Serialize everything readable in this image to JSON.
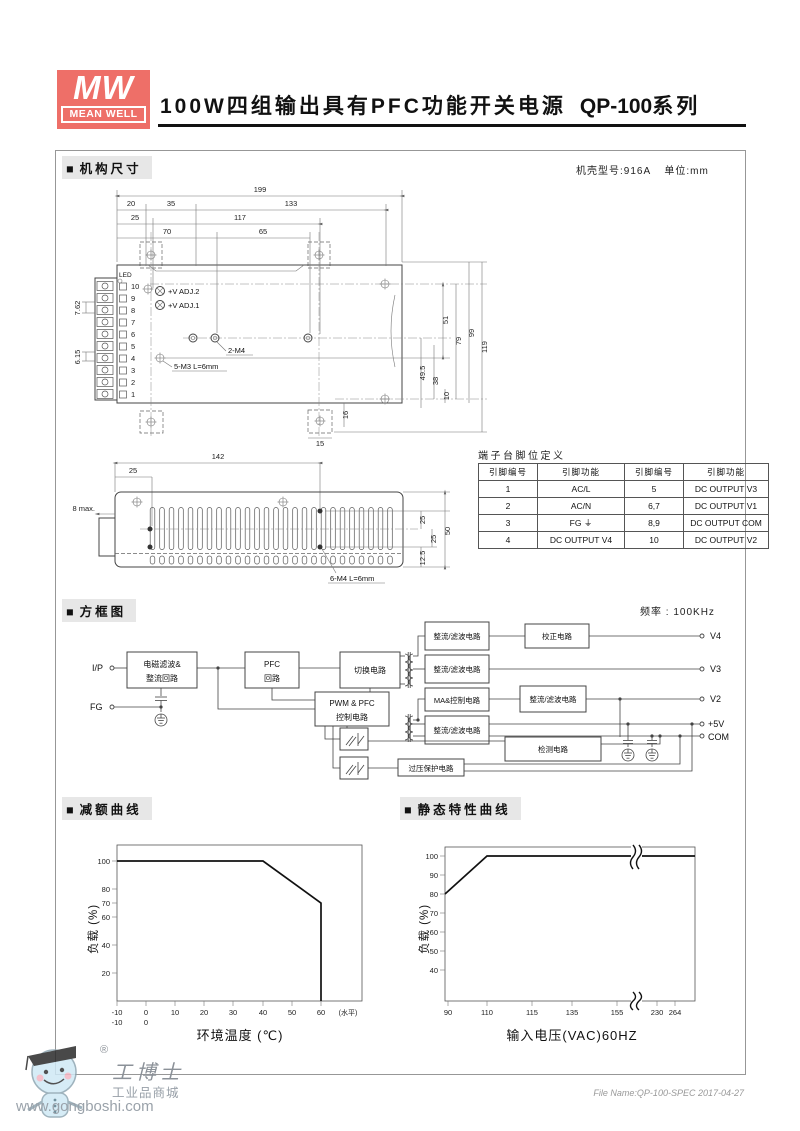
{
  "colors": {
    "brand": "#ee6f68",
    "section_bg": "#e7e7e7",
    "line": "#444444",
    "watermark": "#98a0a8"
  },
  "header": {
    "logo_mw": "MW",
    "logo_name": "MEAN WELL",
    "title": "100W四组输出具有PFC功能开关电源",
    "series": "QP-100",
    "series_suffix": "系列"
  },
  "mech": {
    "bullet": "■",
    "section_title": "机构尺寸",
    "case_model": "机壳型号:916A",
    "unit": "单位:mm",
    "top_view": {
      "dims": {
        "d199": "199",
        "d20": "20",
        "d35": "35",
        "d133": "133",
        "d25": "25",
        "d117": "117",
        "d70": "70",
        "d65": "65",
        "d51": "51",
        "d79": "79",
        "d99": "99",
        "d119": "119",
        "d49_5": "49.5",
        "d38": "38",
        "d10": "10",
        "d16": "16",
        "d15": "15",
        "d7_62": "7.62",
        "d6_15": "6.15"
      },
      "labels": {
        "led": "LED",
        "vadj2": "+V ADJ.2",
        "vadj1": "+V ADJ.1",
        "m4": "2-M4",
        "m3": "5-M3 L=6mm"
      },
      "terminals": [
        "10",
        "9",
        "8",
        "7",
        "6",
        "5",
        "4",
        "3",
        "2",
        "1"
      ]
    },
    "side_view": {
      "dims": {
        "s142": "142",
        "s25": "25",
        "s8max": "8 max.",
        "s25a": "25",
        "s25b": "25",
        "s12_5": "12.5",
        "s50": "50"
      },
      "labels": {
        "m4": "6-M4 L=6mm"
      }
    }
  },
  "pin_table": {
    "title": "端子台脚位定义",
    "headers": [
      "引脚编号",
      "引脚功能",
      "引脚编号",
      "引脚功能"
    ],
    "rows": [
      [
        "1",
        "AC/L",
        "5",
        "DC OUTPUT V3"
      ],
      [
        "2",
        "AC/N",
        "6,7",
        "DC OUTPUT V1"
      ],
      [
        "3",
        "FG ⏚",
        "8,9",
        "DC OUTPUT COM"
      ],
      [
        "4",
        "DC OUTPUT V4",
        "10",
        "DC OUTPUT V2"
      ]
    ]
  },
  "block_diagram": {
    "bullet": "■",
    "section_title": "方框图",
    "freq": "频率 : 100KHz",
    "ports": {
      "ip": "I/P",
      "fg": "FG",
      "v4": "V4",
      "v3": "V3",
      "v2": "V2",
      "p5v": "+5V",
      "com": "COM"
    },
    "blocks": {
      "emi1": "电磁滤波&",
      "emi2": "整流回路",
      "pfc1": "PFC",
      "pfc2": "回路",
      "sw": "切换电路",
      "rf": "整流/滤波电路",
      "corr": "校正电路",
      "ma": "MA&控制电路",
      "det": "检测电路",
      "pwm1": "PWM & PFC",
      "pwm2": "控制电路",
      "ovp": "过压保护电路"
    }
  },
  "charts": {
    "bullet": "■"
  },
  "chart_data": [
    {
      "type": "line",
      "title": "减额曲线",
      "xlabel": "环境温度 (℃)",
      "ylabel": "负载 (%)",
      "x_note": "(水平)",
      "x_ticks": [
        "-10",
        "0",
        "10",
        "20",
        "30",
        "40",
        "50",
        "60"
      ],
      "x_ticks_row2": [
        "-10",
        "0"
      ],
      "y_ticks": [
        "100",
        "80",
        "70",
        "60",
        "40",
        "20"
      ],
      "points": [
        [
          -10,
          100
        ],
        [
          40,
          100
        ],
        [
          60,
          70
        ],
        [
          60,
          0
        ]
      ],
      "xlim": [
        -10,
        70
      ],
      "ylim": [
        0,
        110
      ],
      "grid": false,
      "legend": "none"
    },
    {
      "type": "line",
      "title": "静态特性曲线",
      "xlabel": "输入电压(VAC)60HZ",
      "ylabel": "负载 (%)",
      "x_ticks": [
        "90",
        "110",
        "115",
        "135",
        "155",
        "230",
        "264"
      ],
      "y_ticks": [
        "100",
        "90",
        "80",
        "70",
        "60",
        "50",
        "40"
      ],
      "points": [
        [
          90,
          80
        ],
        [
          110,
          100
        ],
        [
          264,
          100
        ]
      ],
      "axis_break_between": [
        155,
        230
      ],
      "ylim": [
        30,
        105
      ],
      "grid": false,
      "legend": "none"
    }
  ],
  "footer": {
    "reg": "®",
    "brand": "工博士",
    "sub": "工业品商城",
    "url": "www.gongboshi.com",
    "file_note": "File Name:QP-100-SPEC  2017-04-27"
  }
}
